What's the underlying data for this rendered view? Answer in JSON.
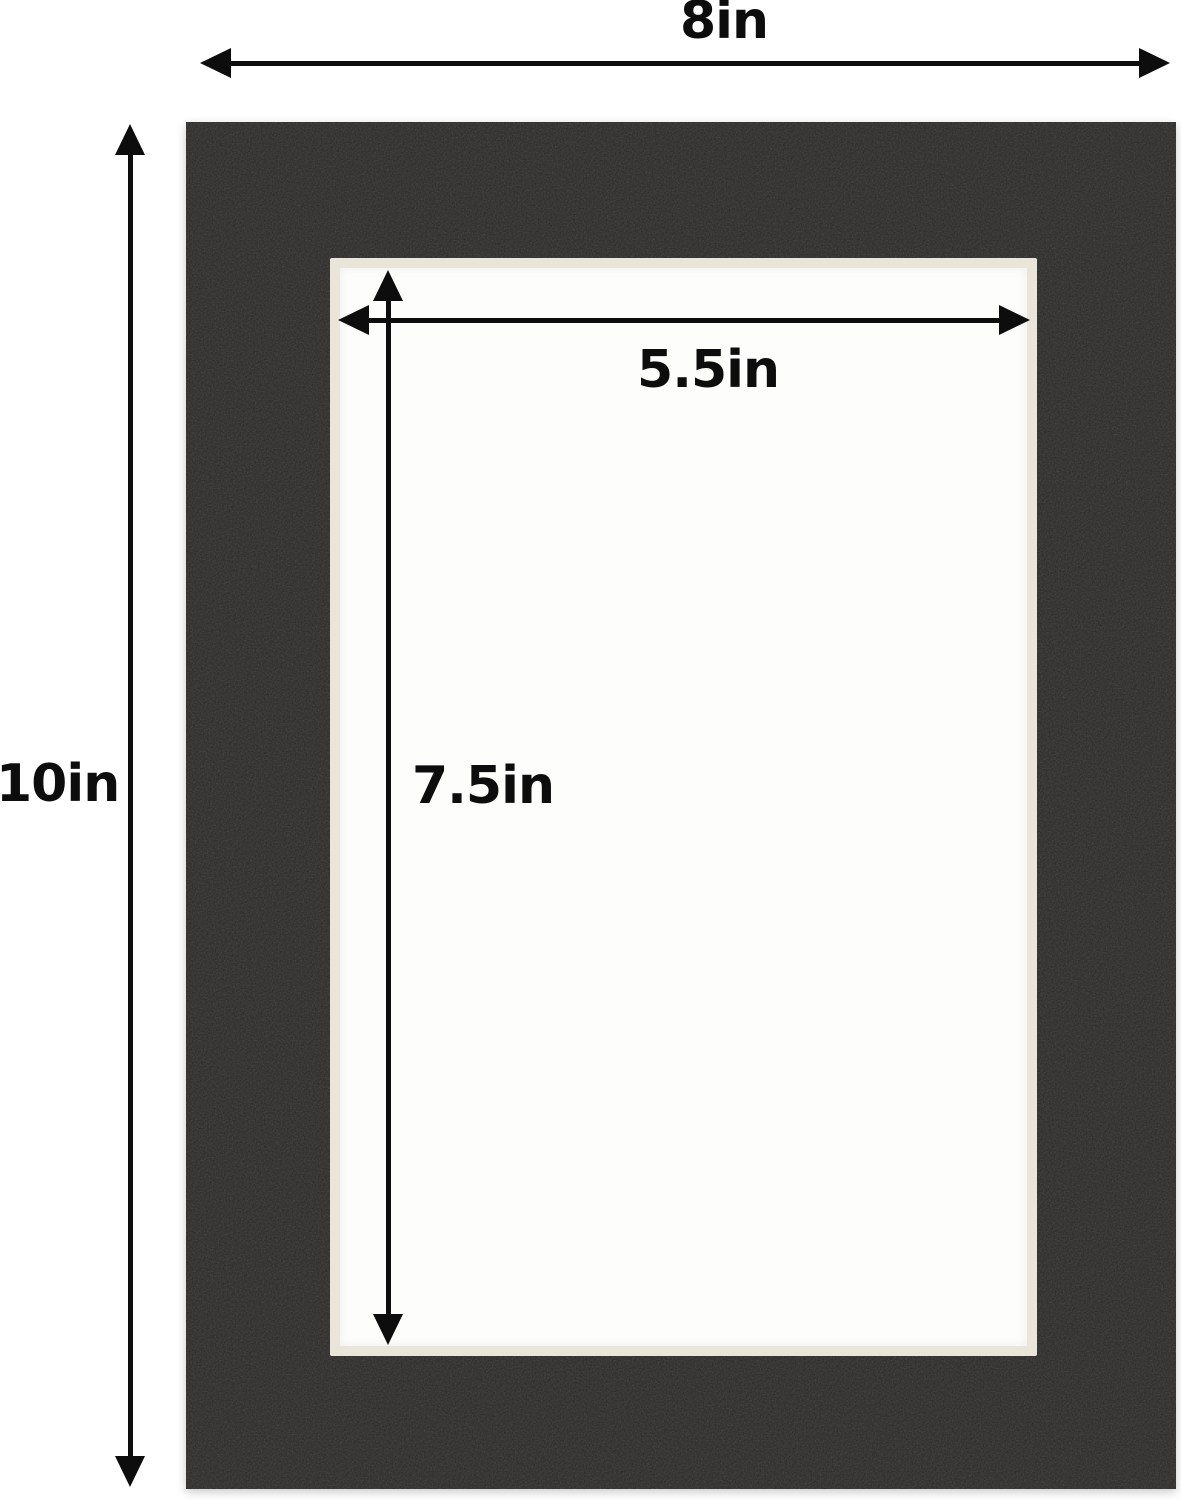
{
  "diagram": {
    "title": "mat board dimension diagram",
    "product": "black picture mat with cream core bevel opening",
    "outer_width": "8in",
    "outer_height": "10in",
    "opening_width": "5.5in",
    "opening_height": "7.5in",
    "colors": {
      "background": "#ffffff",
      "mat_black": "#2b2927",
      "bevel_cream": "#e9e6d9",
      "window_white": "#fdfdfc",
      "annotation_black": "#0d0d0d"
    }
  }
}
